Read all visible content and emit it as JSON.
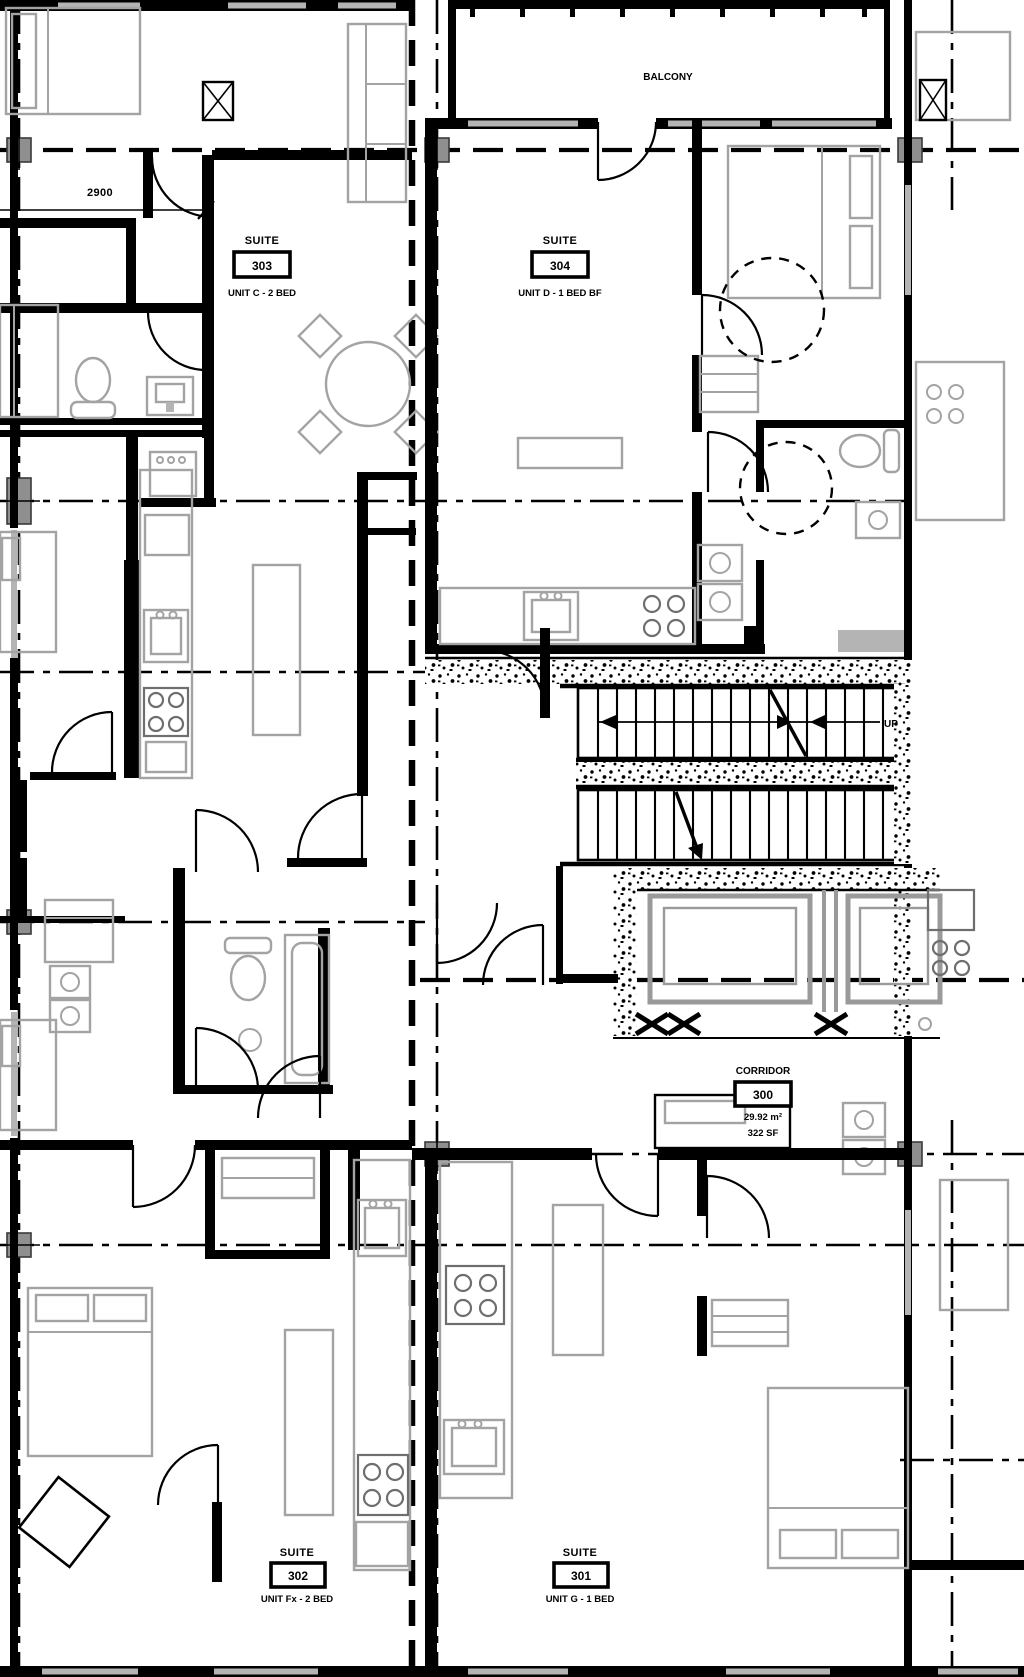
{
  "plan": {
    "balcony_label": "BALCONY",
    "dimension_width": "2900",
    "up_label": "UP",
    "suites": [
      {
        "id": "303",
        "type_label": "SUITE",
        "number": "303",
        "unit": "UNIT C - 2 BED"
      },
      {
        "id": "304",
        "type_label": "SUITE",
        "number": "304",
        "unit": "UNIT D - 1 BED BF"
      },
      {
        "id": "302",
        "type_label": "SUITE",
        "number": "302",
        "unit": "UNIT Fx - 2 BED"
      },
      {
        "id": "301",
        "type_label": "SUITE",
        "number": "301",
        "unit": "UNIT G - 1 BED"
      }
    ],
    "corridor": {
      "label": "CORRIDOR",
      "number": "300",
      "area_metric": "29.92 m²",
      "area_imperial": "322 SF"
    },
    "colors": {
      "wall": "#000000",
      "furniture_gray": "#a3a3a3",
      "column_gray": "#8f8f8f",
      "background": "#ffffff"
    }
  }
}
